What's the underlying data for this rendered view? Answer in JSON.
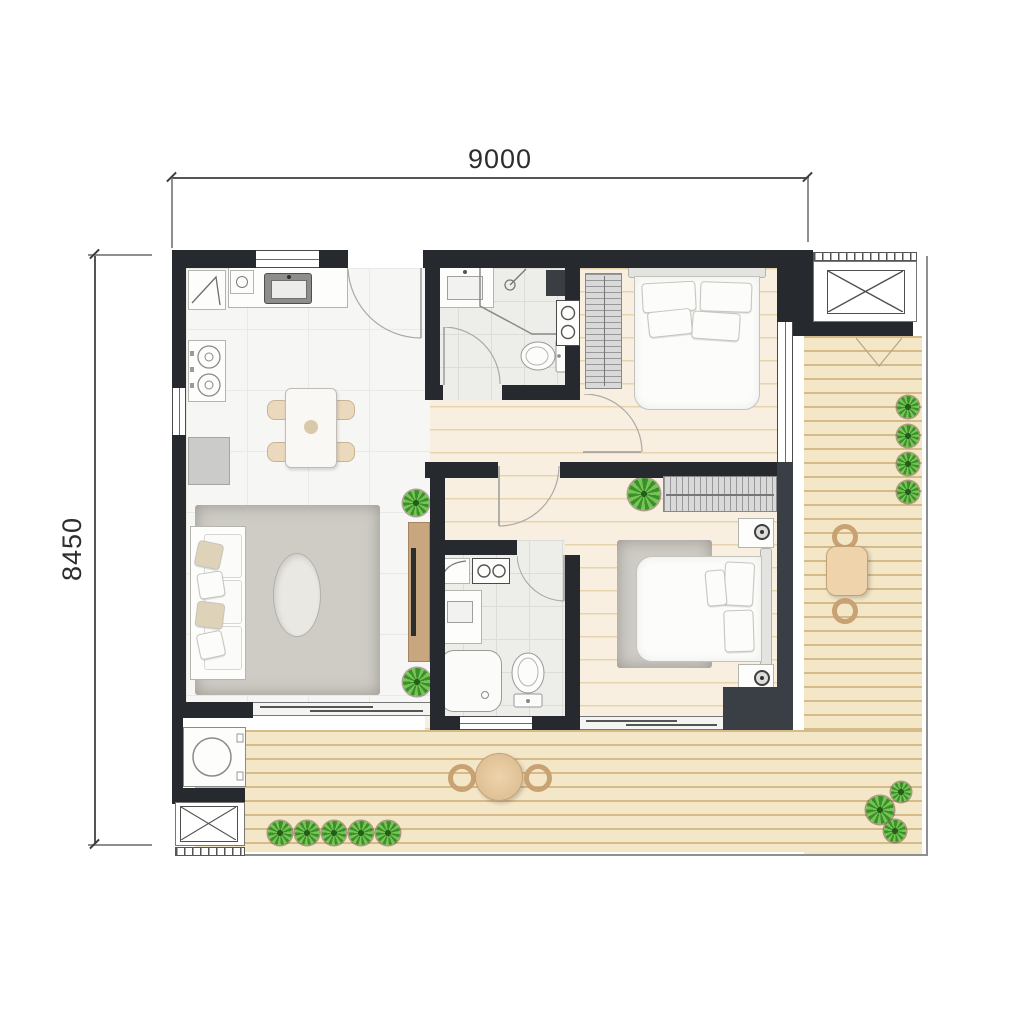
{
  "dimensions": {
    "top_label": "9000",
    "left_label": "8450"
  },
  "palette": {
    "wall": "#26292e",
    "wall_light": "#3a3f45",
    "wood_floor": "#f8efe0",
    "balcony_deck": "#f4e7c8",
    "tile_floor": "#f6f6f4",
    "bath_floor": "#ededea",
    "rug": "#cfccc6",
    "wood_furniture": "#c8a67f",
    "plant_green": "#5aae3d",
    "dimension_text": "#2d2d2d"
  },
  "rooms": {
    "living_dining": {
      "items": [
        "sofa",
        "area-rug",
        "coffee-table",
        "tv-console",
        "dining-table",
        "dining-chairs",
        "potted-plants"
      ]
    },
    "kitchen": {
      "items": [
        "counter",
        "sink",
        "gas-stove",
        "flue-shaft",
        "refrigerator",
        "window"
      ]
    },
    "bathroom_1": {
      "items": [
        "vanity-sink",
        "corner-shower",
        "toilet",
        "laundry-stack",
        "door"
      ]
    },
    "bathroom_2": {
      "items": [
        "vanity-sink",
        "shower-tray",
        "toilet",
        "water-heater",
        "washer-knobs",
        "door",
        "window"
      ]
    },
    "bedroom_1": {
      "items": [
        "double-bed",
        "wardrobe",
        "door",
        "balcony-window"
      ]
    },
    "bedroom_2": {
      "items": [
        "double-bed",
        "wardrobe",
        "nightstand",
        "table-lamp",
        "area-rug",
        "potted-plant",
        "door",
        "balcony-window"
      ]
    },
    "balcony": {
      "items": [
        "deck-boards",
        "round-table",
        "square-table",
        "deck-chairs",
        "potted-plants",
        "washing-machine",
        "railing"
      ]
    },
    "service": {
      "items": [
        "ac-platform-top-right",
        "ac-platform-bottom-left",
        "louver-vents"
      ]
    }
  }
}
